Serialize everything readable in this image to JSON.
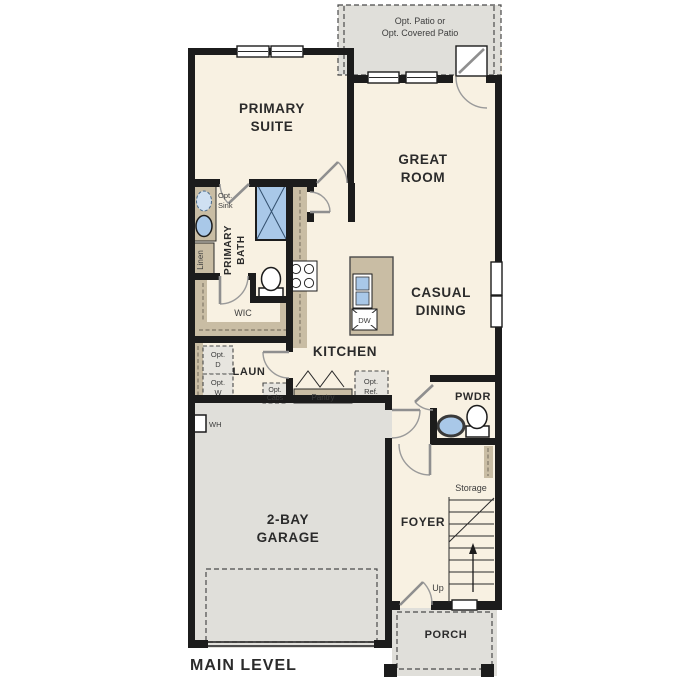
{
  "palette": {
    "wall": "#1c1c1c",
    "floor": "#f8f1e2",
    "concrete": "#e0dfda",
    "cabinet": "#c9bda4",
    "fixture_blue": "#a9c8e8",
    "door_arc": "#9a9a9a",
    "label_text": "#2b2b2b",
    "small_text": "#3d3d3d"
  },
  "labels": {
    "patio": [
      "Opt. Patio or",
      "Opt. Covered Patio"
    ],
    "primary_suite": [
      "PRIMARY",
      "SUITE"
    ],
    "great_room": [
      "GREAT",
      "ROOM"
    ],
    "casual_dining": [
      "CASUAL",
      "DINING"
    ],
    "kitchen": "KITCHEN",
    "garage": [
      "2-BAY",
      "GARAGE"
    ],
    "foyer": "FOYER",
    "porch": "PORCH",
    "pwdr": "PWDR",
    "laun": "LAUN",
    "wic": "WIC",
    "primary_bath": [
      "PRIMARY",
      "BATH"
    ],
    "linen": "Linen",
    "opt_sink": [
      "Opt.",
      "Sink"
    ],
    "opt_d": [
      "Opt.",
      "D"
    ],
    "opt_w": [
      "Opt.",
      "W"
    ],
    "opt_cabs": [
      "Opt.",
      "Cabs"
    ],
    "pantry": "Pantry",
    "opt_ref": [
      "Opt.",
      "Ref."
    ],
    "dw": "DW",
    "wh": "WH",
    "storage": "Storage",
    "up": "Up",
    "main_level": "MAIN LEVEL"
  }
}
